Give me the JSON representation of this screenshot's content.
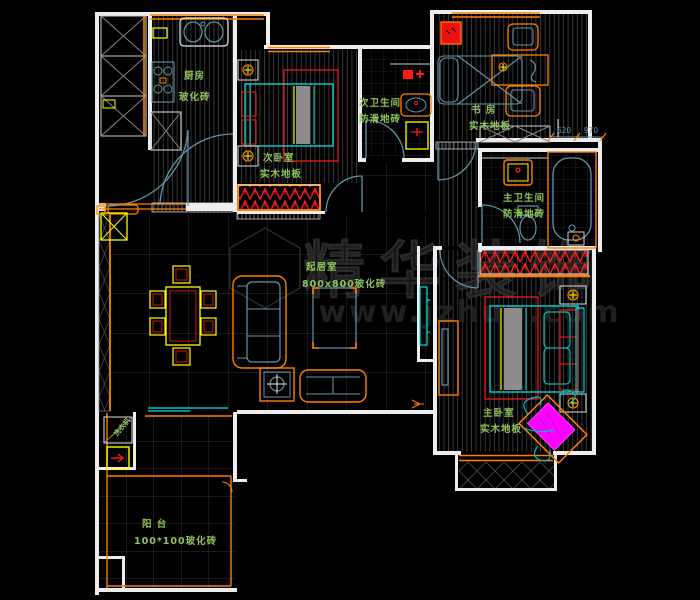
{
  "plan": {
    "rooms": {
      "kitchen": {
        "name": "厨房",
        "floor": "玻化砖"
      },
      "bedroom2": {
        "name": "次卧室",
        "floor": "实木地板"
      },
      "bath2": {
        "name": "次卫生间",
        "floor": "防滑地砖"
      },
      "study": {
        "name": "书 房",
        "floor": "实木地板"
      },
      "bath1": {
        "name": "主卫生间",
        "floor": "防滑地砖"
      },
      "bedroom1": {
        "name": "主卧室",
        "floor": "实木地板"
      },
      "living": {
        "name": "起居室",
        "floor": "800x800玻化砖"
      },
      "balcony": {
        "name": "阳 台",
        "floor": "100*100玻化砖"
      }
    },
    "appliances": {
      "washer": "洗衣机"
    },
    "dimensions": {
      "d1": "620",
      "d2": "970"
    },
    "watermark": {
      "brand": "精华装饰",
      "url": "www.jzhua.com"
    },
    "colors": {
      "wall": "#ededed",
      "orange": "#ff8000",
      "red": "#ff1a1a",
      "cyan": "#00e5e5",
      "yellow": "#ffff00",
      "blue": "#6495aa",
      "green": "#8fc45a",
      "magenta": "#ff00ff"
    }
  }
}
